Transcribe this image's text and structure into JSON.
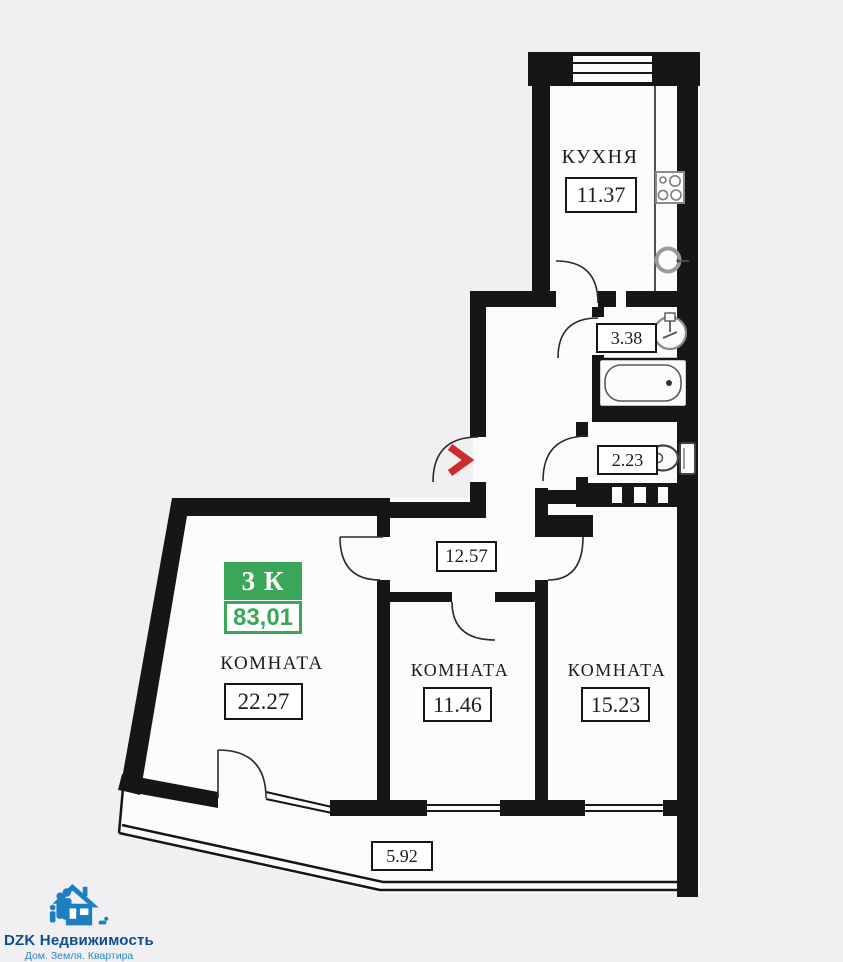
{
  "plan": {
    "badge": {
      "rooms_label": "3 К",
      "total_area": "83,01"
    },
    "rooms": {
      "kitchen": {
        "name": "КУХНЯ",
        "area": "11.37"
      },
      "bathroom": {
        "area": "3.38"
      },
      "toilet": {
        "area": "2.23"
      },
      "hallway": {
        "area": "12.57"
      },
      "living_room": {
        "name": "КОМНАТА",
        "area": "22.27"
      },
      "bedroom_middle": {
        "name": "КОМНАТА",
        "area": "11.46"
      },
      "bedroom_right": {
        "name": "КОМНАТА",
        "area": "15.23"
      },
      "balcony": {
        "area": "5.92"
      }
    },
    "icons": {
      "entry": "entry-chevron-icon",
      "stove": "stove-icon",
      "kitchen_sink": "sink-icon",
      "bathroom_sink": "washbasin-icon",
      "bathtub": "bathtub-icon",
      "toilet": "toilet-icon"
    }
  },
  "logo": {
    "title": "DZK Недвижимость",
    "tagline": "Дом. Земля. Квартира"
  },
  "colors": {
    "background": "#f0f0f2",
    "wall_black": "#161616",
    "badge_green": "#3aa65a",
    "entry_red": "#cb2d2d",
    "logo_title_blue": "#0d4e91",
    "logo_accent_blue": "#2e86c6",
    "logo_icon_blue": "#1e7ec2"
  }
}
